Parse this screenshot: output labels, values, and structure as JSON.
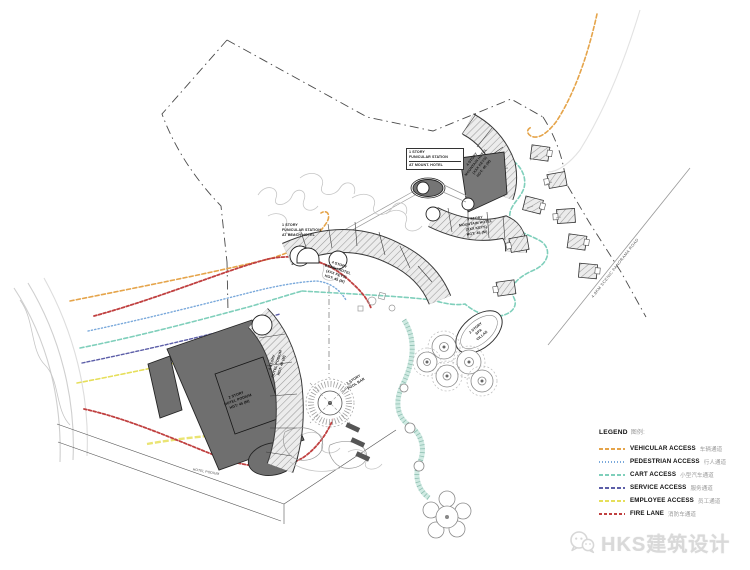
{
  "legend": {
    "title_en": "LEGEND",
    "title_zh": "图例:",
    "items": [
      {
        "en": "VEHICULAR ACCESS",
        "zh": "车辆通道",
        "color": "#E5A44A",
        "dash": "4 2"
      },
      {
        "en": "PEDESTRIAN ACCESS",
        "zh": "行人通道",
        "color": "#7AA9DB",
        "dash": "1 2"
      },
      {
        "en": "CART ACCESS",
        "zh": "小型汽车通道",
        "color": "#7FCFBB",
        "dash": "4 2"
      },
      {
        "en": "SERVICE ACCESS",
        "zh": "服务通道",
        "color": "#5C5EA8",
        "dash": "4 2"
      },
      {
        "en": "EMPLOYEE ACCESS",
        "zh": "员工通道",
        "color": "#E6DF5A",
        "dash": "4 2"
      },
      {
        "en": "FIRE LANE",
        "zh": "消防车通道",
        "color": "#C04040",
        "dash": "3 2"
      }
    ]
  },
  "labels": {
    "funicular_mount": {
      "lines": [
        "1 STORY",
        "FUNICULAR STATION",
        "AT MOUNT. HOTEL"
      ]
    },
    "funicular_beach": {
      "lines": [
        "1 STORY",
        "FUNICULAR STATION",
        "AT BEACH HOTEL"
      ]
    },
    "mountain_upper": {
      "lines": [
        "4 STORY",
        "MOUNTAIN HOTEL",
        "(XXX KEYS)",
        "HGT: 45 (M)"
      ]
    },
    "mountain_lower": {
      "lines": [
        "3 STORY",
        "MOUNTAIN HOTEL",
        "(XXX KEYS)",
        "HGT: 45 (M)"
      ]
    },
    "beach_arc": {
      "lines": [
        "4 STORY",
        "BEACH HOTEL",
        "(XXX KEYS)",
        "HGT: 45 (M)"
      ]
    },
    "podium_band": {
      "lines": [
        "4 STORY",
        "HOTEL PODIUM",
        "HGT: 45 (M)"
      ]
    },
    "podium_dark": {
      "lines": [
        "2 STORY",
        "HOTEL PODIUM",
        "HGT: 45 (M)"
      ]
    },
    "spa": {
      "lines": [
        "2 STORY",
        "SPA",
        "VILLAS"
      ]
    },
    "pool_bar": {
      "lines": [
        "1 STORY",
        "POOL BAR"
      ]
    },
    "podium_note": "HOTEL PODIUM",
    "scenic_road": "4.8KM SCENIC PANORAMA ROAD"
  },
  "watermark": {
    "text": "HKS建筑设计"
  }
}
